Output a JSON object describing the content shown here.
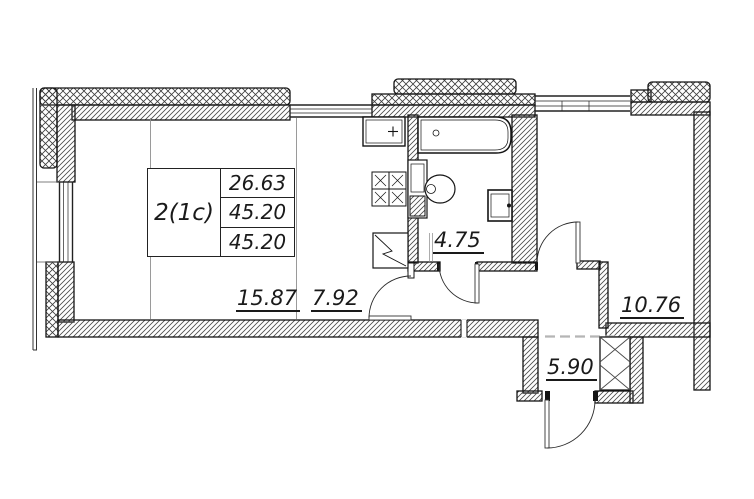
{
  "info_table": {
    "type": "2(1c)",
    "values": [
      "26.63",
      "45.20",
      "45.20"
    ]
  },
  "room_areas": {
    "living": "15.87",
    "kitchen": "7.92",
    "bathroom": "4.75",
    "bedroom": "10.76",
    "hall": "5.90"
  },
  "colors": {
    "ink": "#141414",
    "hatch": "#4a4a4a",
    "zone_line": "#8f8f8f",
    "dash_line": "#b5b5b5"
  }
}
